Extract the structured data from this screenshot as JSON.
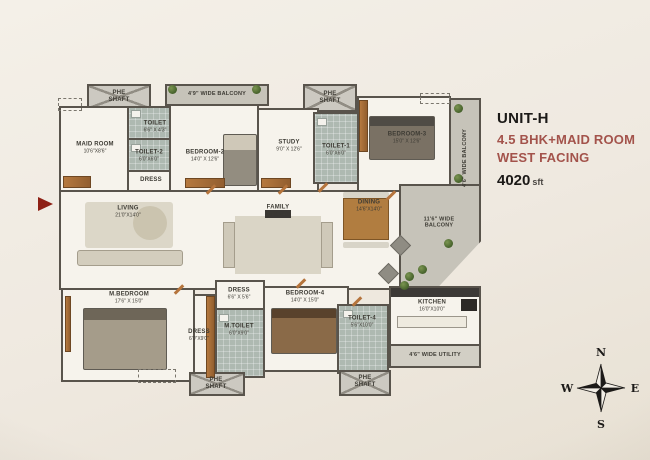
{
  "header": {
    "unit": "UNIT-H",
    "subtitle1": "4.5 BHK+MAID ROOM",
    "subtitle2": "WEST FACING",
    "area_value": "4020",
    "area_unit": "sft",
    "accent_color": "#A3534B"
  },
  "compass": {
    "north": "N",
    "east": "E",
    "south": "S",
    "west": "W"
  },
  "plan": {
    "rooms": [
      {
        "name": "PHE SHAFT",
        "dims": ""
      },
      {
        "name": "TOILET",
        "dims": "6'6\" X 4'3\""
      },
      {
        "name": "MAID ROOM",
        "dims": "10'6\"X8'6\""
      },
      {
        "name": "TOILET-2",
        "dims": "6'0\"X6'0\""
      },
      {
        "name": "DRESS",
        "dims": ""
      },
      {
        "name": "BEDROOM-2",
        "dims": "14'0\" X 12'6\""
      },
      {
        "name": "4'9\" WIDE BALCONY",
        "dims": ""
      },
      {
        "name": "STUDY",
        "dims": "9'0\" X 12'6\""
      },
      {
        "name": "PHE SHAFT",
        "dims": ""
      },
      {
        "name": "TOILET-1",
        "dims": "6'0\"X6'0\""
      },
      {
        "name": "BEDROOM-3",
        "dims": "15'0\" X 12'6\""
      },
      {
        "name": "4'6\" WIDE BALCONY",
        "dims": ""
      },
      {
        "name": "LIVING",
        "dims": "21'0\"X14'0\""
      },
      {
        "name": "FAMILY",
        "dims": "20'8\"X14'0\""
      },
      {
        "name": "DINING",
        "dims": "14'6\"X14'0\""
      },
      {
        "name": "11'6\" WIDE BALCONY",
        "dims": ""
      },
      {
        "name": "M.BEDROOM",
        "dims": "17'6\" X 15'0\""
      },
      {
        "name": "DRESS",
        "dims": "6'0\"X9'0\""
      },
      {
        "name": "DRESS",
        "dims": "6'6\" X 5'6\""
      },
      {
        "name": "M.TOILET",
        "dims": "6'0\"X9'0\""
      },
      {
        "name": "BEDROOM-4",
        "dims": "14'0\" X 15'0\""
      },
      {
        "name": "TOILET-4",
        "dims": "5'6\"X10'0\""
      },
      {
        "name": "PHE SHAFT",
        "dims": ""
      },
      {
        "name": "PHE SHAFT",
        "dims": ""
      },
      {
        "name": "KITCHEN",
        "dims": "16'0\"X10'0\""
      },
      {
        "name": "4'6\" WIDE UTILITY",
        "dims": ""
      }
    ]
  }
}
